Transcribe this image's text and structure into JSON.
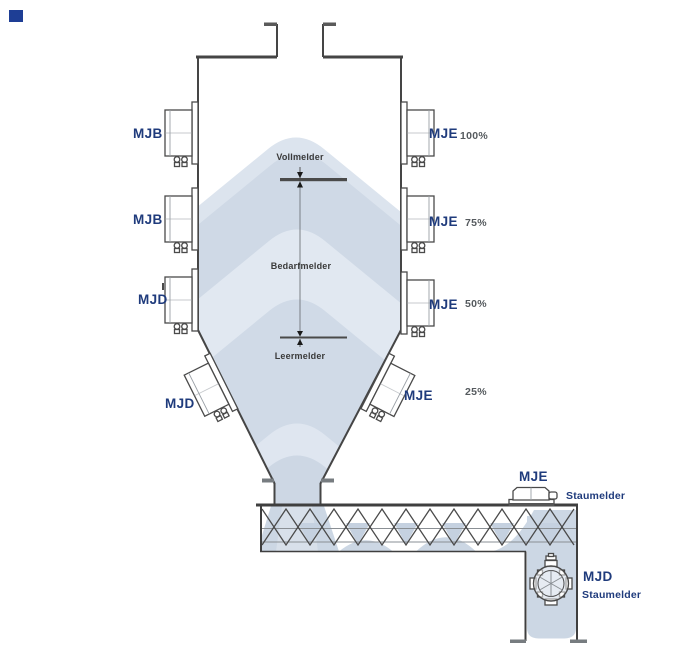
{
  "diagram": {
    "type": "silo-level-monitoring",
    "colors": {
      "label_navy": "#1f3b7c",
      "percent_gray": "#555a5e",
      "annotation_gray": "#3a3a3a",
      "outline": "#454545",
      "material": "#cfd9e6",
      "material_light": "#e1e8f1",
      "corner_mark": "#1e3e95"
    },
    "silo_sensors_left": [
      {
        "label": "MJB"
      },
      {
        "label": "MJB"
      },
      {
        "label": "MJD"
      },
      {
        "label": "MJD"
      }
    ],
    "silo_sensors_right": [
      {
        "label": "MJE",
        "level": "100%"
      },
      {
        "label": "MJE",
        "level": "75%"
      },
      {
        "label": "MJE",
        "level": "50%"
      },
      {
        "label": "MJE",
        "level": "25%"
      }
    ],
    "level_annotations": {
      "full": "Vollmelder",
      "demand": "Bedarfmelder",
      "empty": "Leermelder"
    },
    "conveyor_sensor": {
      "label": "MJE",
      "type": "Staumelder"
    },
    "discharge_sensor": {
      "label": "MJD",
      "type": "Staumelder"
    }
  }
}
